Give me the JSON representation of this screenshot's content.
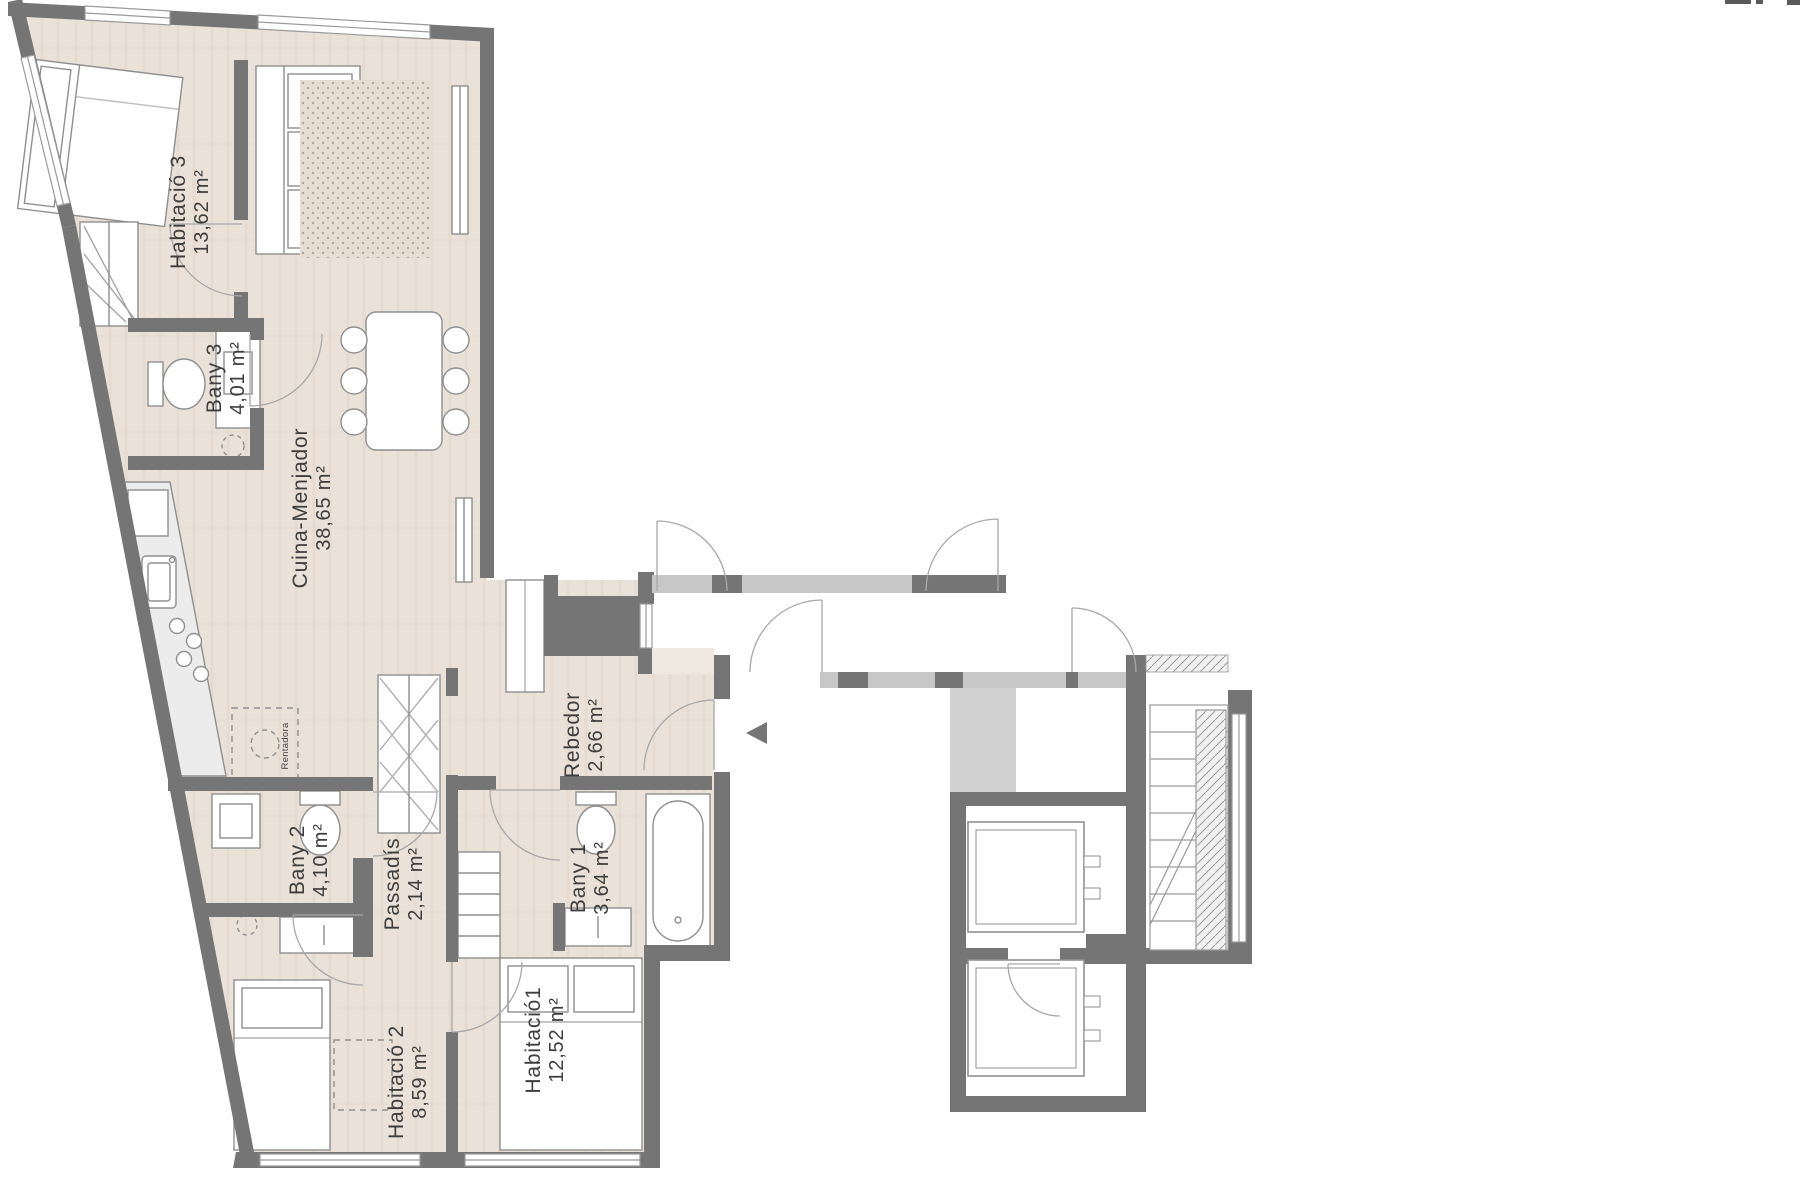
{
  "plan": {
    "title": "Apartment floor plan",
    "language": "ca",
    "rooms": [
      {
        "id": "habitacio-3",
        "name": "Habitació 3",
        "area": "13,62 m²"
      },
      {
        "id": "bany-3",
        "name": "Bany 3",
        "area": "4,01 m²"
      },
      {
        "id": "cuina-menjador",
        "name": "Cuina-Menjador",
        "area": "38,65 m²"
      },
      {
        "id": "rebedor",
        "name": "Rebedor",
        "area": "2,66 m²"
      },
      {
        "id": "bany-2",
        "name": "Bany 2",
        "area": "4,10 m²"
      },
      {
        "id": "passadis",
        "name": "Passadís",
        "area": "2,14 m²"
      },
      {
        "id": "bany-1",
        "name": "Bany 1",
        "area": "3,64 m²"
      },
      {
        "id": "habitacio-2",
        "name": "Habitació 2",
        "area": "8,59 m²"
      },
      {
        "id": "habitacio-1",
        "name": "Habitació1",
        "area": "12,52 m²"
      }
    ],
    "appliance_label": "Rentadora",
    "entrance_marker": "entry-arrow",
    "colors": {
      "wall_dark": "#757575",
      "wall_light": "#c7c7c7",
      "floor_beige": "#eae1d8",
      "floor_line": "#ddd1c5",
      "furniture_stroke": "#8f8f8f",
      "counter_fill": "#ececec",
      "door_arc": "#a8a8a8",
      "label_text": "#3d3d3d"
    }
  }
}
